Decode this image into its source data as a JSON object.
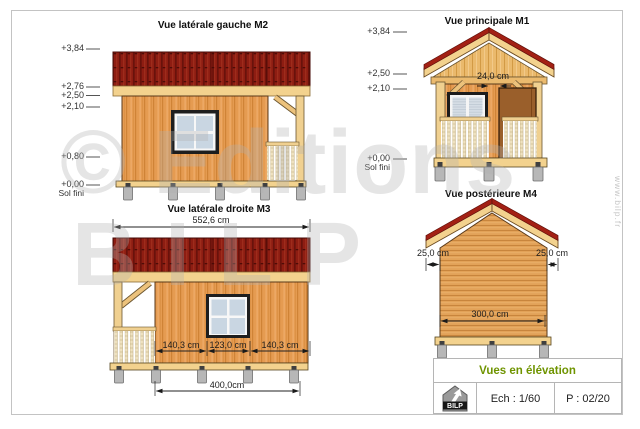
{
  "sheet": {
    "watermark_line1": "© Editions",
    "watermark_line2": "BILP",
    "website": "www.bilp.fr"
  },
  "views": {
    "m2": {
      "title": "Vue latérale gauche M2",
      "levels": [
        "+3,84",
        "+2,76",
        "+2,50",
        "+2,10",
        "+0,80",
        "+0,00"
      ],
      "ground_label": "Sol fini"
    },
    "m1": {
      "title": "Vue principale M1",
      "levels": [
        "+3,84",
        "+2,50",
        "+2,10",
        "+0,00"
      ],
      "ground_label": "Sol fini",
      "jamb_dim": "24,0 cm"
    },
    "m3": {
      "title": "Vue latérale droite M3",
      "total_width_dim": "552,6 cm",
      "left_dim": "140,3 cm",
      "window_dim": "123,0 cm",
      "right_dim": "140,3 cm",
      "body_dim": "400,0cm"
    },
    "m4": {
      "title": "Vue postérieure M4",
      "left_overhang_dim": "25,0 cm",
      "right_overhang_dim": "25,0 cm",
      "wall_width_dim": "300,0 cm"
    }
  },
  "title_block": {
    "drawing_title": "Vues en élévation",
    "scale": "Ech : 1/60",
    "page": "P : 02/20",
    "logo_text": "BILP"
  },
  "colors": {
    "roof_red": "#8E1D12",
    "wall_wood": "#E59B51",
    "trim_tan": "#F3D28E",
    "door_brown": "#9A5F2B",
    "glass_blue": "#C9D6E2",
    "footing_grey": "#B7B7B7",
    "accent_green": "#6F9400"
  }
}
